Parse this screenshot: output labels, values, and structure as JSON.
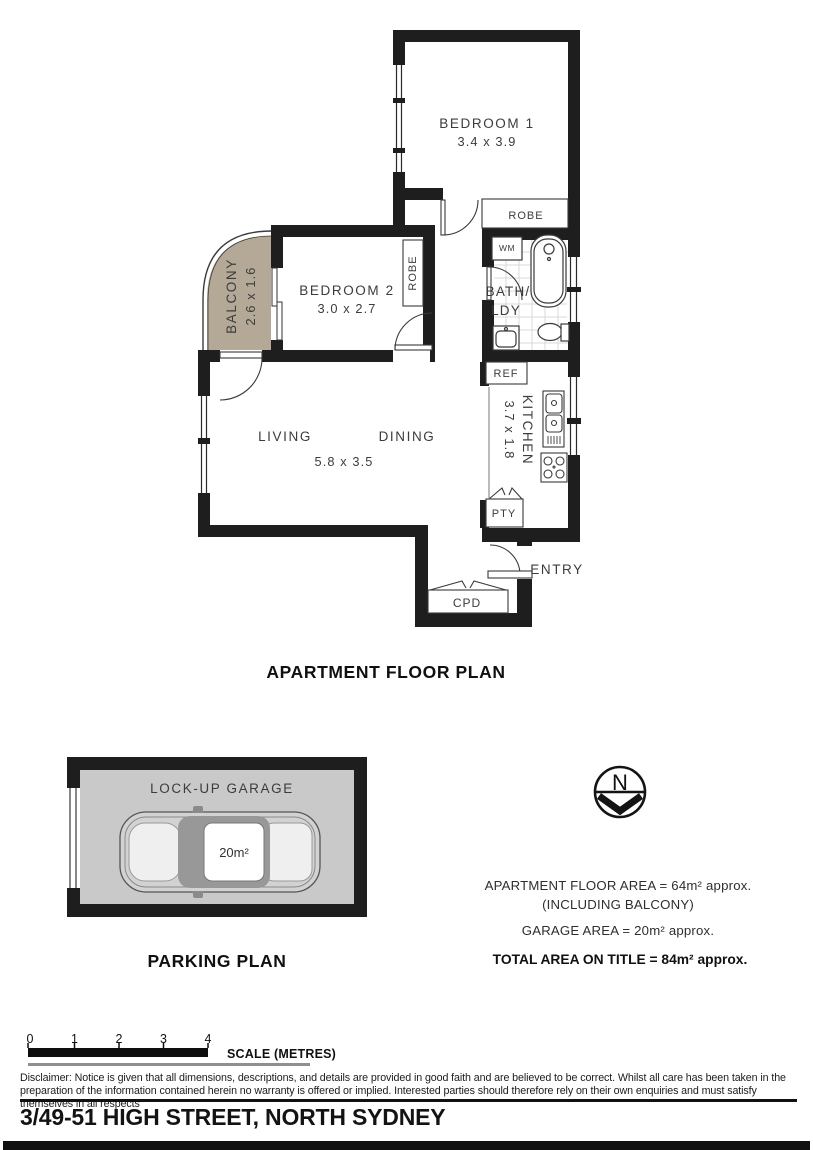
{
  "floor_plan": {
    "title": "APARTMENT FLOOR PLAN",
    "bedroom1": {
      "name": "BEDROOM 1",
      "dims": "3.4 x 3.9"
    },
    "bedroom2": {
      "name": "BEDROOM 2",
      "dims": "3.0 x 2.7"
    },
    "balcony": {
      "name": "BALCONY",
      "dims": "2.6 x 1.6"
    },
    "living_label": "LIVING",
    "dining_label": "DINING",
    "living_dining_dims": "5.8 x 3.5",
    "kitchen": {
      "name": "KITCHEN",
      "dims": "3.7 x 1.8"
    },
    "bath": {
      "line1": "BATH/",
      "line2": "LDY"
    },
    "robe_bed1": "ROBE",
    "robe_bed2": "ROBE",
    "wm": "WM",
    "ref": "REF",
    "pty": "PTY",
    "cpd": "CPD",
    "entry": "ENTRY"
  },
  "parking_plan": {
    "title": "PARKING PLAN",
    "garage_label": "LOCK-UP GARAGE",
    "garage_area": "20m²"
  },
  "compass": {
    "north": "N"
  },
  "summary": {
    "apartment_area": "APARTMENT FLOOR AREA = 64m² approx.",
    "including": "(INCLUDING BALCONY)",
    "garage_area": "GARAGE AREA = 20m² approx.",
    "total_area": "TOTAL AREA ON TITLE = 84m² approx."
  },
  "scale_bar": {
    "labels": [
      "0",
      "1",
      "2",
      "3",
      "4"
    ],
    "caption": "SCALE (METRES)"
  },
  "disclaimer": "Disclaimer: Notice is given that all dimensions, descriptions, and details are provided in good faith and are believed to be correct. Whilst all care has been taken in the preparation of the information contained herein no warranty is offered or implied. Interested parties should therefore rely on their own enquiries and must satisfy themselves in all respects",
  "address": "3/49-51 HIGH STREET, NORTH SYDNEY",
  "colors": {
    "wall": "#1e1e1e",
    "balcony_fill": "#b3a996",
    "garage_fill": "#c9c9c9"
  }
}
